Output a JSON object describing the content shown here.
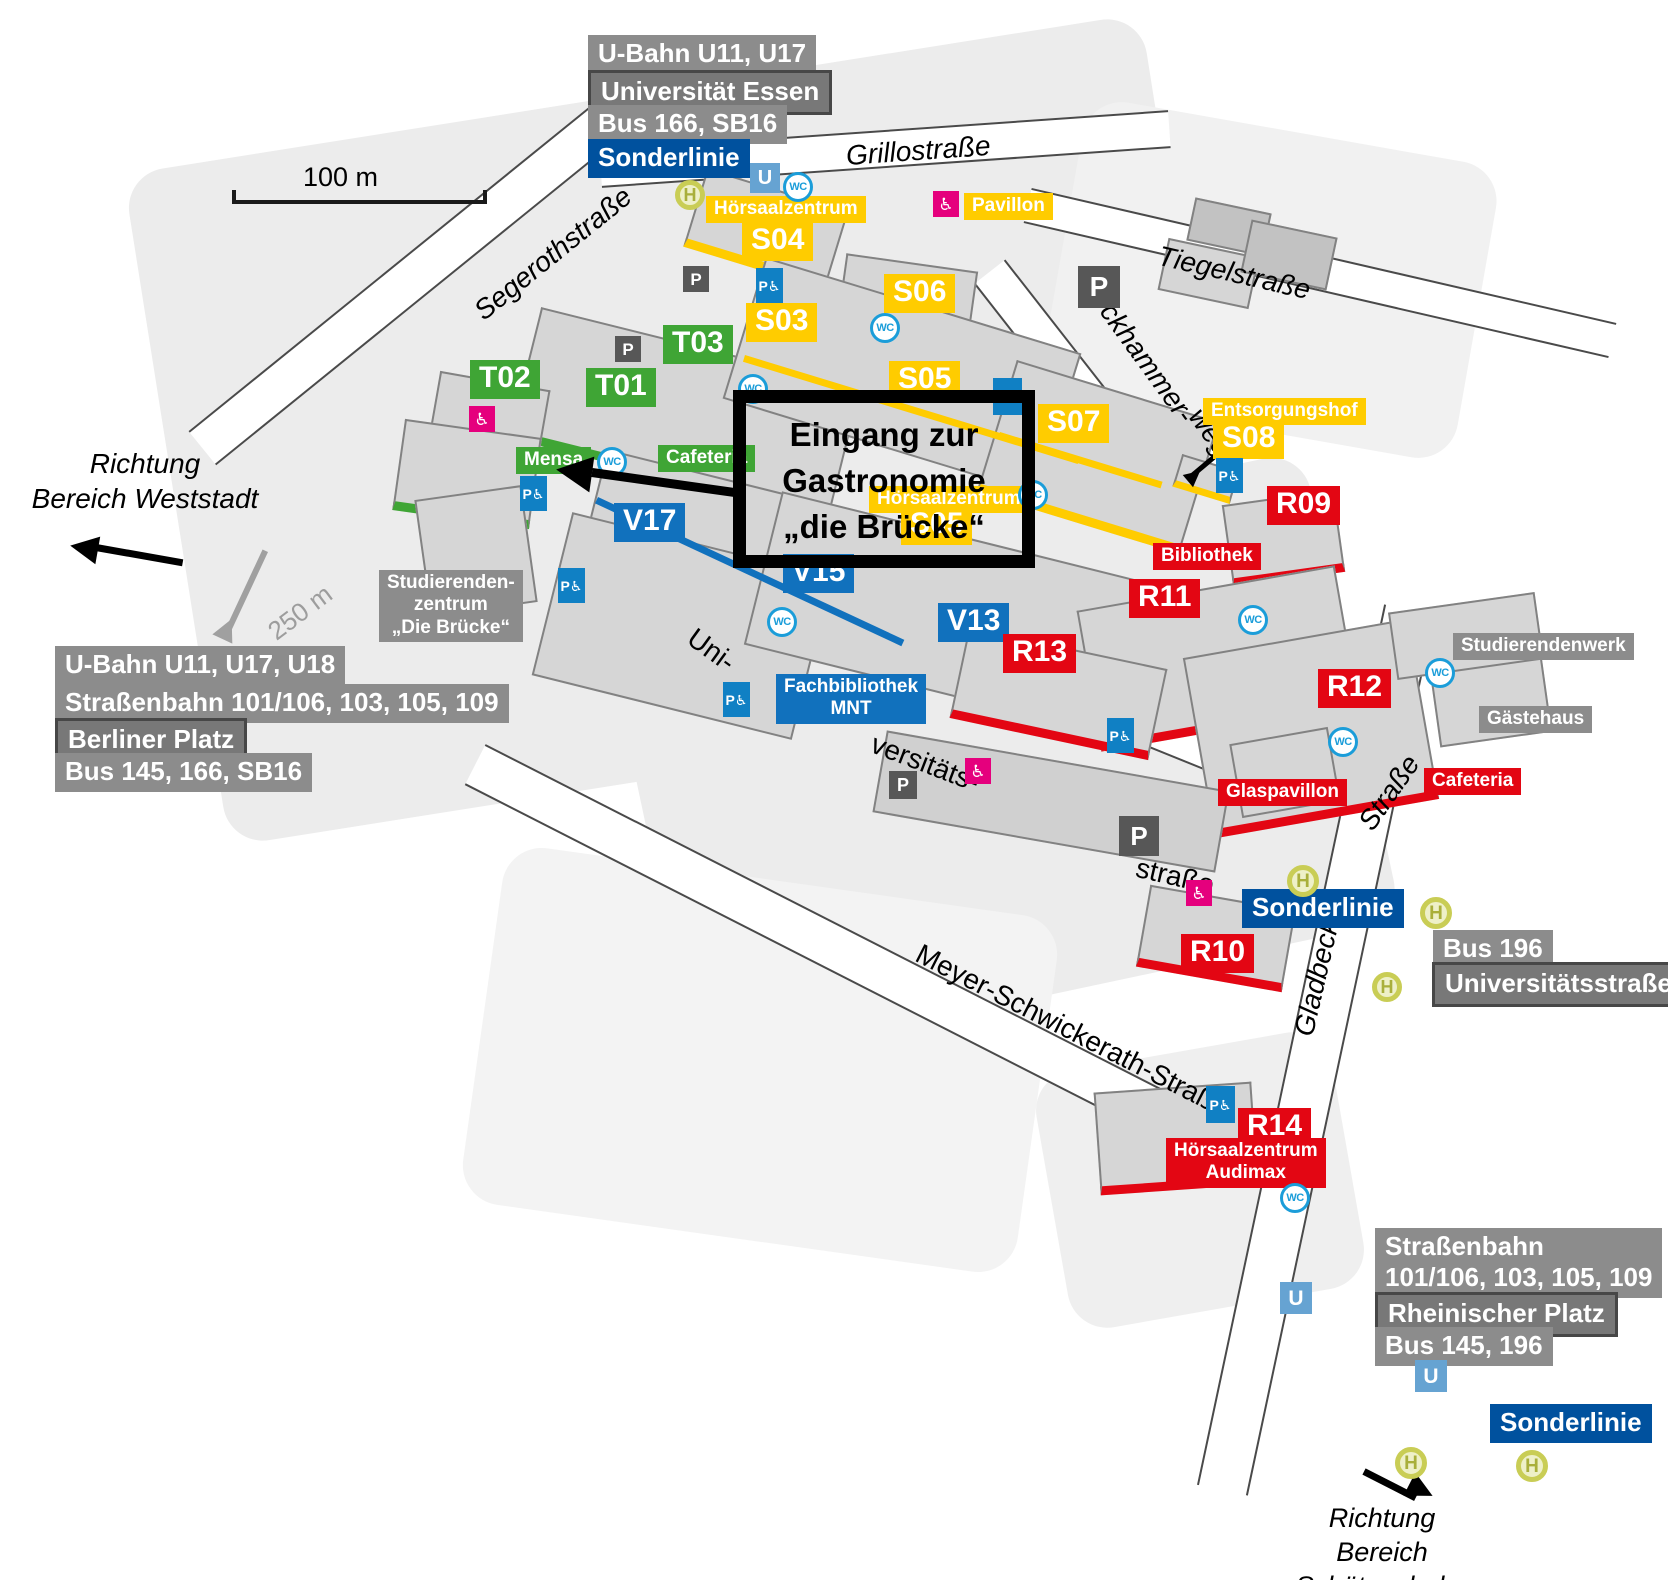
{
  "colors": {
    "green_t_buildings": "#3FA535",
    "yellow_s_buildings": "#FFCC00",
    "blue_v_buildings": "#1171BD",
    "red_r_buildings": "#E30613",
    "transit_gray": "#8C8C8C",
    "station_gray": "#787878",
    "sonderlinie_blue": "#00519E",
    "ubahn_icon_blue": "#66A3D2",
    "wc_blue": "#1B9DD9",
    "parking_dark": "#575757",
    "parking_accessible_blue": "#1080C4",
    "accessible_pink": "#E5007D",
    "h_stop_olive": "#C9CD55"
  },
  "annotation": {
    "lines": [
      "Eingang zur",
      "Gastronomie",
      "„die Brücke“"
    ]
  },
  "scale_bar": {
    "label": "100 m"
  },
  "directions": {
    "weststadt": {
      "line1": "Richtung",
      "line2": "Bereich Weststadt"
    },
    "schuetzenbahn": {
      "line1": "Richtung",
      "line2": "Bereich Schützenbahn"
    }
  },
  "map_labels": [
    {
      "id": "transit-ubahn-u11-u17",
      "kind": "box graybox",
      "text": "U-Bahn U11, U17",
      "x": 588,
      "y": 35
    },
    {
      "id": "transit-universitaet-essen",
      "kind": "box graydark",
      "text": "Universität Essen",
      "x": 588,
      "y": 70
    },
    {
      "id": "transit-bus-166-sb16",
      "kind": "box graybox",
      "text": "Bus 166, SB16",
      "x": 588,
      "y": 105
    },
    {
      "id": "transit-sonderlinie-nw",
      "kind": "box bluedark",
      "text": "Sonderlinie",
      "x": 588,
      "y": 139
    },
    {
      "id": "street-grillostrasse",
      "kind": "street italic",
      "text": "Grillostraße",
      "x": 845,
      "y": 140,
      "rot": -4
    },
    {
      "id": "street-segerothstrasse",
      "kind": "street italic",
      "text": "Segerothstraße",
      "x": 468,
      "y": 302,
      "rot": -39
    },
    {
      "id": "street-tiegelstrasse",
      "kind": "street italic",
      "text": "Tiegelstraße",
      "x": 1162,
      "y": 240,
      "rot": 13
    },
    {
      "id": "street-reckhammer",
      "kind": "street italic",
      "text": "Reckhammer-",
      "x": 1098,
      "y": 268,
      "rot": 54
    },
    {
      "id": "street-weg",
      "kind": "street italic",
      "text": "weg",
      "x": 1208,
      "y": 402,
      "rot": 54
    },
    {
      "id": "street-uni",
      "kind": "street",
      "text": "Uni-",
      "x": 700,
      "y": 622,
      "rot": 36
    },
    {
      "id": "street-versitaets",
      "kind": "street",
      "text": "versitäts-",
      "x": 878,
      "y": 728,
      "rot": 21
    },
    {
      "id": "street-strasse-campus",
      "kind": "street",
      "text": "straße",
      "x": 1140,
      "y": 852,
      "rot": 13
    },
    {
      "id": "street-meyer-schwickerath",
      "kind": "street",
      "text": "Meyer-Schwickerath-Straße",
      "x": 925,
      "y": 938,
      "rot": 27
    },
    {
      "id": "street-gladbecker",
      "kind": "street italic",
      "text": "Gladbecker",
      "x": 1288,
      "y": 1032,
      "rot": -77
    },
    {
      "id": "street-strasse-gladbecker",
      "kind": "street italic",
      "text": "Straße",
      "x": 1352,
      "y": 818,
      "rot": -55
    },
    {
      "id": "scale-250m",
      "kind": "street gray250",
      "text": "250 m",
      "x": 262,
      "y": 622,
      "rot": -37
    },
    {
      "id": "label-hoersaalzentrum-s04",
      "kind": "small yellow",
      "text": "Hörsaalzentrum",
      "x": 706,
      "y": 196
    },
    {
      "id": "building-s04",
      "kind": "big yellow",
      "text": "S04",
      "x": 742,
      "y": 222
    },
    {
      "id": "label-pavillon",
      "kind": "small yellow",
      "text": "Pavillon",
      "x": 964,
      "y": 193
    },
    {
      "id": "building-s03",
      "kind": "big yellow",
      "text": "S03",
      "x": 746,
      "y": 303
    },
    {
      "id": "building-s06",
      "kind": "big yellow",
      "text": "S06",
      "x": 884,
      "y": 274
    },
    {
      "id": "building-s05",
      "kind": "big yellow",
      "text": "S05",
      "x": 889,
      "y": 361
    },
    {
      "id": "building-s07",
      "kind": "big yellow",
      "text": "S07",
      "x": 1038,
      "y": 404
    },
    {
      "id": "label-entsorgungshof",
      "kind": "small yellow",
      "text": "Entsorgungshof",
      "x": 1203,
      "y": 398
    },
    {
      "id": "building-s08",
      "kind": "big yellow",
      "text": "S08",
      "x": 1213,
      "y": 420
    },
    {
      "id": "label-hoersaalzentrum-center",
      "kind": "small yellow",
      "text": "Hörsaalzentrum",
      "x": 869,
      "y": 486
    },
    {
      "id": "building-s05-center",
      "kind": "big yellow",
      "text": "S05",
      "x": 901,
      "y": 506
    },
    {
      "id": "building-t02",
      "kind": "big green",
      "text": "T02",
      "x": 470,
      "y": 360
    },
    {
      "id": "building-t01",
      "kind": "big green",
      "text": "T01",
      "x": 586,
      "y": 368
    },
    {
      "id": "building-t03",
      "kind": "big green",
      "text": "T03",
      "x": 663,
      "y": 325
    },
    {
      "id": "label-mensa",
      "kind": "small green",
      "text": "Mensa",
      "x": 516,
      "y": 447
    },
    {
      "id": "label-cafeteria-west",
      "kind": "small green",
      "text": "Cafeteria",
      "x": 658,
      "y": 445
    },
    {
      "id": "building-v17",
      "kind": "big blue",
      "text": "V17",
      "x": 614,
      "y": 503
    },
    {
      "id": "building-v15",
      "kind": "big blue",
      "text": "V15",
      "x": 783,
      "y": 554
    },
    {
      "id": "building-v13",
      "kind": "big blue",
      "text": "V13",
      "x": 938,
      "y": 603
    },
    {
      "id": "label-fachbibliothek-mnt",
      "kind": "small blue center",
      "lines": [
        "Fachbibliothek",
        "MNT"
      ],
      "x": 776,
      "y": 674
    },
    {
      "id": "building-r09",
      "kind": "big red",
      "text": "R09",
      "x": 1267,
      "y": 486
    },
    {
      "id": "label-bibliothek",
      "kind": "small red",
      "text": "Bibliothek",
      "x": 1153,
      "y": 543
    },
    {
      "id": "building-r11",
      "kind": "big red",
      "text": "R11",
      "x": 1129,
      "y": 579
    },
    {
      "id": "building-r13",
      "kind": "big red",
      "text": "R13",
      "x": 1003,
      "y": 634
    },
    {
      "id": "building-r12",
      "kind": "big red",
      "text": "R12",
      "x": 1318,
      "y": 669
    },
    {
      "id": "label-glaspavillon",
      "kind": "small red",
      "text": "Glaspavillon",
      "x": 1218,
      "y": 779
    },
    {
      "id": "label-cafeteria-east",
      "kind": "small red",
      "text": "Cafeteria",
      "x": 1424,
      "y": 768
    },
    {
      "id": "building-r10",
      "kind": "big red",
      "text": "R10",
      "x": 1181,
      "y": 934
    },
    {
      "id": "building-r14",
      "kind": "big red",
      "text": "R14",
      "x": 1238,
      "y": 1108
    },
    {
      "id": "label-hoersaalzentrum-audimax",
      "kind": "small red center",
      "lines": [
        "Hörsaalzentrum",
        "Audimax"
      ],
      "x": 1166,
      "y": 1138
    },
    {
      "id": "label-studierendenzentrum",
      "kind": "small graybox center",
      "lines": [
        "Studierenden-",
        "zentrum",
        "„Die Brücke“"
      ],
      "x": 379,
      "y": 570
    },
    {
      "id": "label-studierendenwerk",
      "kind": "small graybox",
      "text": "Studierendenwerk",
      "x": 1453,
      "y": 633
    },
    {
      "id": "label-gaestehaus",
      "kind": "small graybox",
      "text": "Gästehaus",
      "x": 1479,
      "y": 706
    },
    {
      "id": "transit-ubahn-berliner",
      "kind": "box graybox",
      "text": "U-Bahn U11, U17, U18",
      "x": 55,
      "y": 646
    },
    {
      "id": "transit-strassenbahn-berliner",
      "kind": "box graybox",
      "text": "Straßenbahn 101/106, 103, 105, 109",
      "x": 55,
      "y": 684
    },
    {
      "id": "transit-berliner-platz",
      "kind": "box graydark",
      "text": "Berliner Platz",
      "x": 55,
      "y": 718
    },
    {
      "id": "transit-bus-145-166",
      "kind": "box graybox",
      "text": "Bus 145, 166, SB16",
      "x": 55,
      "y": 753
    },
    {
      "id": "transit-sonderlinie-mid",
      "kind": "box bluedark",
      "text": "Sonderlinie",
      "x": 1242,
      "y": 889
    },
    {
      "id": "transit-bus-196",
      "kind": "box graybox",
      "text": "Bus 196",
      "x": 1433,
      "y": 930
    },
    {
      "id": "transit-universitaetsstrasse",
      "kind": "box graydark",
      "text": "Universitätsstraße",
      "x": 1432,
      "y": 962
    },
    {
      "id": "transit-strassenbahn-rheinischer",
      "kind": "box graybox",
      "lines": [
        "Straßenbahn",
        "101/106, 103, 105, 109"
      ],
      "x": 1375,
      "y": 1228
    },
    {
      "id": "transit-rheinischer-platz",
      "kind": "box graydark",
      "text": "Rheinischer Platz",
      "x": 1375,
      "y": 1292
    },
    {
      "id": "transit-bus-145-196",
      "kind": "box graybox",
      "text": "Bus 145, 196",
      "x": 1375,
      "y": 1327
    },
    {
      "id": "transit-sonderlinie-se",
      "kind": "box bluedark",
      "text": "Sonderlinie",
      "x": 1490,
      "y": 1404
    }
  ],
  "map_icons": [
    {
      "type": "h-stop",
      "x": 675,
      "y": 180,
      "s": 30
    },
    {
      "type": "h-stop",
      "x": 1287,
      "y": 865,
      "s": 32
    },
    {
      "type": "h-stop",
      "x": 1420,
      "y": 897,
      "s": 32
    },
    {
      "type": "h-stop",
      "x": 1372,
      "y": 972,
      "s": 30
    },
    {
      "type": "h-stop",
      "x": 1395,
      "y": 1447,
      "s": 32
    },
    {
      "type": "h-stop",
      "x": 1516,
      "y": 1450,
      "s": 32
    },
    {
      "type": "u-bahn",
      "x": 750,
      "y": 163,
      "s": 30
    },
    {
      "type": "u-bahn",
      "x": 1280,
      "y": 1282,
      "s": 32
    },
    {
      "type": "u-bahn",
      "x": 1415,
      "y": 1360,
      "s": 32
    },
    {
      "type": "wc",
      "x": 783,
      "y": 172,
      "s": 30
    },
    {
      "type": "wc",
      "x": 870,
      "y": 313,
      "s": 30
    },
    {
      "type": "wc",
      "x": 738,
      "y": 374,
      "s": 30
    },
    {
      "type": "wc",
      "x": 597,
      "y": 447,
      "s": 30
    },
    {
      "type": "wc",
      "x": 1018,
      "y": 480,
      "s": 30
    },
    {
      "type": "wc",
      "x": 767,
      "y": 607,
      "s": 30
    },
    {
      "type": "wc",
      "x": 1238,
      "y": 605,
      "s": 30
    },
    {
      "type": "wc",
      "x": 1425,
      "y": 658,
      "s": 30
    },
    {
      "type": "wc",
      "x": 1328,
      "y": 727,
      "s": 30
    },
    {
      "type": "wc",
      "x": 1280,
      "y": 1183,
      "s": 30
    },
    {
      "type": "parking",
      "x": 683,
      "y": 266,
      "s": 26
    },
    {
      "type": "parking",
      "x": 615,
      "y": 336,
      "s": 26
    },
    {
      "type": "parking",
      "x": 1078,
      "y": 266,
      "s": 42
    },
    {
      "type": "parking",
      "x": 889,
      "y": 771,
      "s": 28
    },
    {
      "type": "parking",
      "x": 1119,
      "y": 816,
      "s": 40
    },
    {
      "type": "parking-accessible",
      "x": 756,
      "y": 268,
      "s": 27
    },
    {
      "type": "parking-accessible",
      "x": 520,
      "y": 476,
      "s": 27
    },
    {
      "type": "parking-accessible",
      "x": 558,
      "y": 568,
      "s": 27
    },
    {
      "type": "parking-accessible",
      "x": 723,
      "y": 682,
      "s": 27
    },
    {
      "type": "parking-accessible",
      "x": 993,
      "y": 378,
      "s": 29
    },
    {
      "type": "parking-accessible",
      "x": 1216,
      "y": 458,
      "s": 27
    },
    {
      "type": "parking-accessible",
      "x": 1107,
      "y": 718,
      "s": 27
    },
    {
      "type": "parking-accessible",
      "x": 1206,
      "y": 1086,
      "s": 29
    },
    {
      "type": "accessible",
      "x": 933,
      "y": 191,
      "s": 26
    },
    {
      "type": "accessible",
      "x": 469,
      "y": 406,
      "s": 26
    },
    {
      "type": "accessible",
      "x": 965,
      "y": 758,
      "s": 26
    },
    {
      "type": "accessible",
      "x": 1186,
      "y": 880,
      "s": 26
    }
  ],
  "icon_glyphs": {
    "h-stop": "H",
    "u-bahn": "U",
    "wc": "WC",
    "parking": "P",
    "parking-accessible": "P♿",
    "accessible": "♿"
  }
}
